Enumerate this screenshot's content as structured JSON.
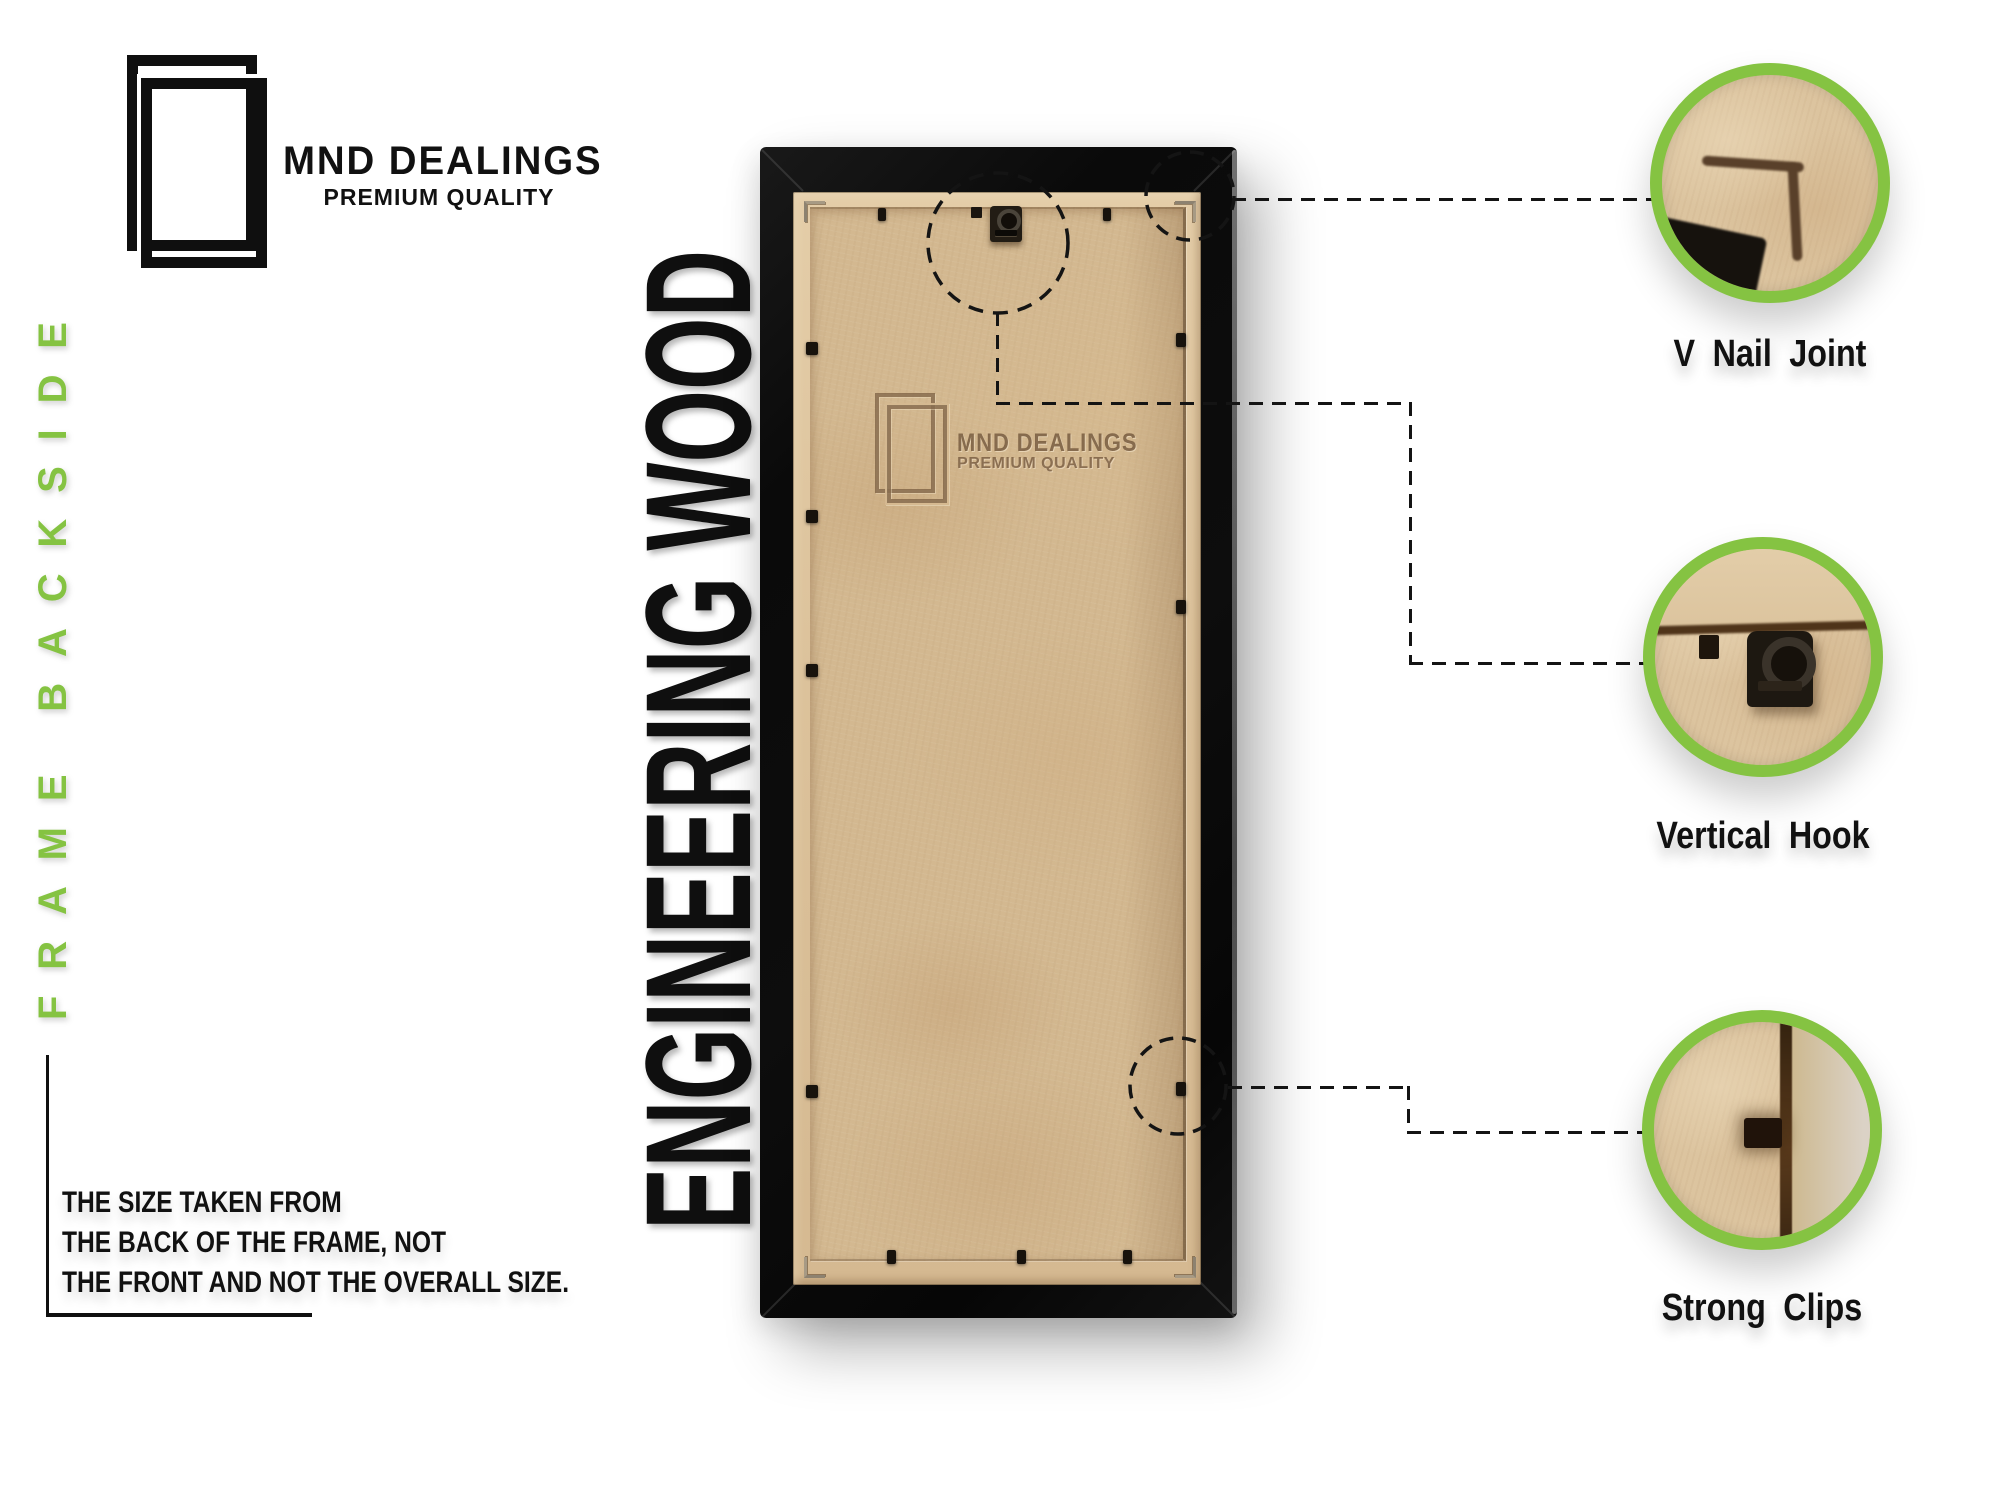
{
  "brand": {
    "name": "MND DEALINGS",
    "tagline": "PREMIUM QUALITY"
  },
  "side_label": "FRAME BACKSIDE",
  "material_label": "ENGINEERING WOOD",
  "note": {
    "lines": [
      "THE SIZE TAKEN FROM",
      "THE BACK OF THE FRAME, NOT",
      "THE FRONT AND NOT THE OVERALL SIZE."
    ]
  },
  "watermark": {
    "name": "MND DEALINGS",
    "tagline": "PREMIUM QUALITY"
  },
  "callouts": [
    {
      "label": "V Nail Joint"
    },
    {
      "label": "Vertical Hook"
    },
    {
      "label": "Strong Clips"
    }
  ],
  "colors": {
    "accent_green": "#85c342",
    "ink_black": "#101010",
    "dash_black": "#141414",
    "wood_tan": "#d3b890",
    "wood_lip": "#dcc29b",
    "emboss_brown": "#76593d",
    "frame_black": "#0d0d0d"
  }
}
